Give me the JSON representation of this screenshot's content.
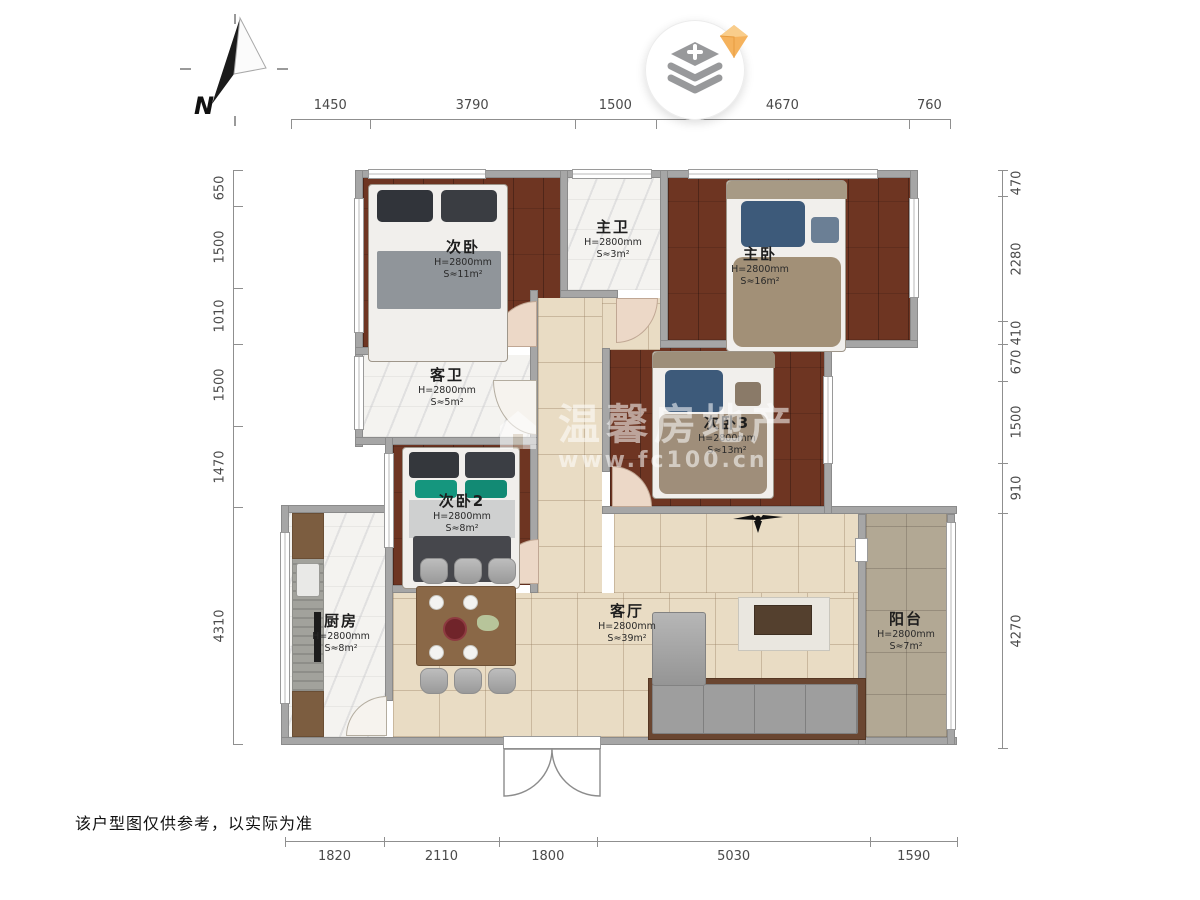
{
  "compass": {
    "label": "N"
  },
  "watermark": {
    "brand": "温馨房地产",
    "url": "www.fc100.cn"
  },
  "disclaimer": "该户型图仅供参考，以实际为准",
  "dimensions": {
    "top": [
      1450,
      3790,
      1500,
      4670,
      760
    ],
    "bottom": [
      1820,
      2110,
      1800,
      5030,
      1590
    ],
    "left": [
      650,
      1500,
      1010,
      1500,
      1470,
      4310
    ],
    "right": [
      470,
      2280,
      410,
      670,
      1500,
      910,
      4270
    ]
  },
  "rooms": [
    {
      "id": "bedroom-2",
      "name": "次卧",
      "height": "H=2800mm",
      "area": "S≈11m²"
    },
    {
      "id": "master-bath",
      "name": "主卫",
      "height": "H=2800mm",
      "area": "S≈3m²"
    },
    {
      "id": "master-bedroom",
      "name": "主卧",
      "height": "H=2800mm",
      "area": "S≈16m²"
    },
    {
      "id": "guest-bath",
      "name": "客卫",
      "height": "H=2800mm",
      "area": "S≈5m²"
    },
    {
      "id": "bedroom-2b",
      "name": "次卧2",
      "height": "H=2800mm",
      "area": "S≈8m²"
    },
    {
      "id": "bedroom-3",
      "name": "次卧3",
      "height": "H=2800mm",
      "area": "S≈13m²"
    },
    {
      "id": "kitchen",
      "name": "厨房",
      "height": "H=2800mm",
      "area": "S≈8m²"
    },
    {
      "id": "living-room",
      "name": "客厅",
      "height": "H=2800mm",
      "area": "S≈39m²"
    },
    {
      "id": "balcony",
      "name": "阳台",
      "height": "H=2800mm",
      "area": "S≈7m²"
    }
  ],
  "colors": {
    "wall": "#a6a6a6",
    "wood_floor": "#6e3522",
    "living_tile": "#e9dcc4",
    "balcony_tile": "#b2a894",
    "marble": "#f4f3f0",
    "door_arc": "#ecd8c7",
    "badge_diamond": "#f5b25c",
    "dimension_text": "#4a4a4a"
  }
}
